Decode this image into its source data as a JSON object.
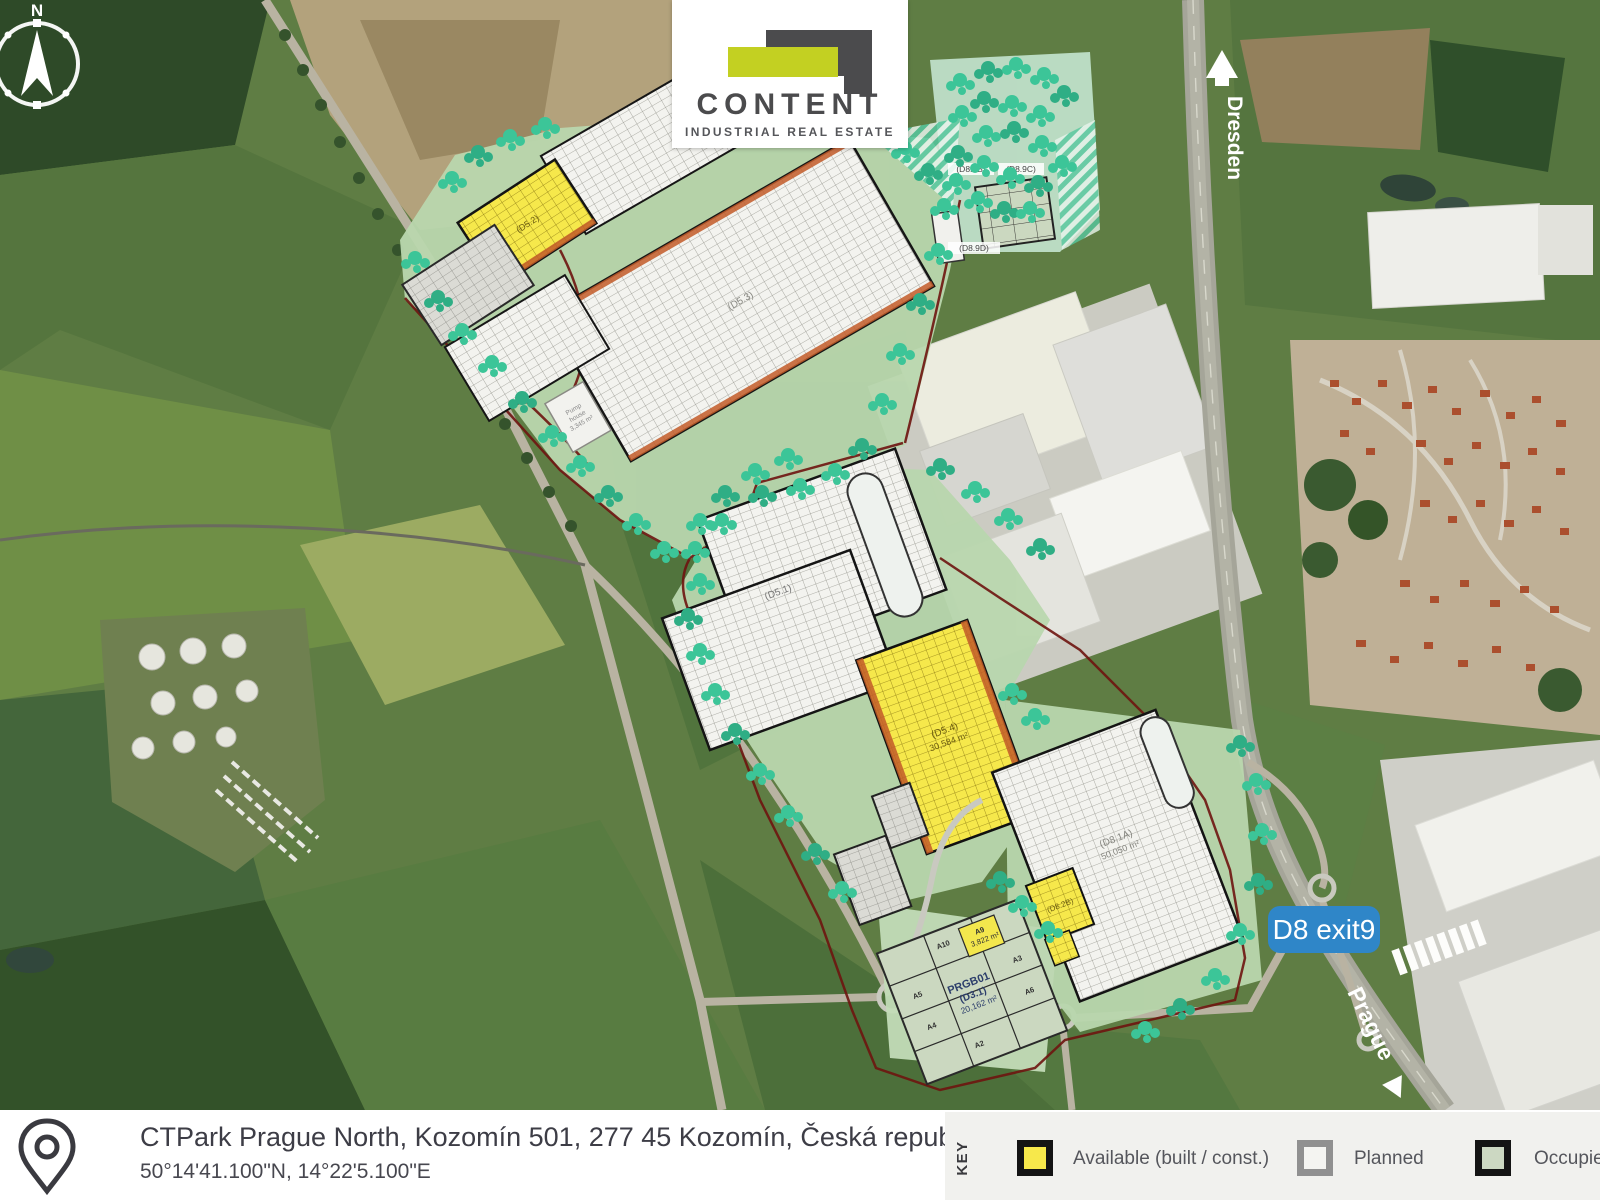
{
  "logo": {
    "title": "CONTENT",
    "subtitle": "INDUSTRIAL REAL ESTATE"
  },
  "compass": {
    "label": "N"
  },
  "road_labels": {
    "north_destination": "Dresden",
    "south_destination": "Prague",
    "exit_badge": "D8 exit9"
  },
  "map_labels": {
    "bldg_d5_2": "(D5.2)",
    "bldg_d5_3": "(D5.3)",
    "bldg_d5_1": "(D5.1)",
    "bldg_d5_4": "(D5.4)",
    "bldg_d5_4_area": "30,584 m²",
    "bldg_d8_1a": "(D8.1A)",
    "bldg_d8_1a_area": "50,050 m²",
    "bldg_d8_2b": "(D8.2B)",
    "parcel_d8_9b": "(D8.9B)",
    "parcel_d8_9c": "(D8.9C)",
    "parcel_d8_9d": "(D8.9D)",
    "bldg_d3_1_name": "PRGB01",
    "bldg_d3_1": "(D3.1)",
    "bldg_d3_1_area": "20,162 m²",
    "pump_house_1": "Pump",
    "pump_house_2": "house",
    "pump_house_area": "3,345 m²",
    "lots": {
      "a10": "A10",
      "a9": "A9",
      "a9_area": "3,822 m²",
      "a5": "A5",
      "a4": "A4",
      "a3": "A3",
      "a2": "A2",
      "a6": "A6"
    }
  },
  "footer": {
    "address": "CTPark Prague North, Kozomín 501, 277 45 Kozomín, Česká republika",
    "coordinates": "50°14'41.100\"N, 14°22'5.100\"E"
  },
  "legend": {
    "title": "KEY",
    "items": [
      {
        "label": "Available (built / const.)",
        "color": "#f7e84b",
        "border": "#141414"
      },
      {
        "label": "Planned",
        "color": "#f4f4f1",
        "border": "#909090"
      },
      {
        "label": "Occupied (",
        "color": "#ccd8c2",
        "border": "#141414"
      }
    ]
  },
  "colors": {
    "available_yellow": "#f7e84b",
    "planned_white": "#f3f3ef",
    "occupied_green": "#cbd8c0",
    "landscape_green": "#b9d7ae",
    "tree_teal": "#3cc598",
    "boundary_red": "#6e1410",
    "exit_badge_blue": "#2f86c8",
    "logo_lime": "#c3d022",
    "logo_gray": "#4b4b4d"
  }
}
